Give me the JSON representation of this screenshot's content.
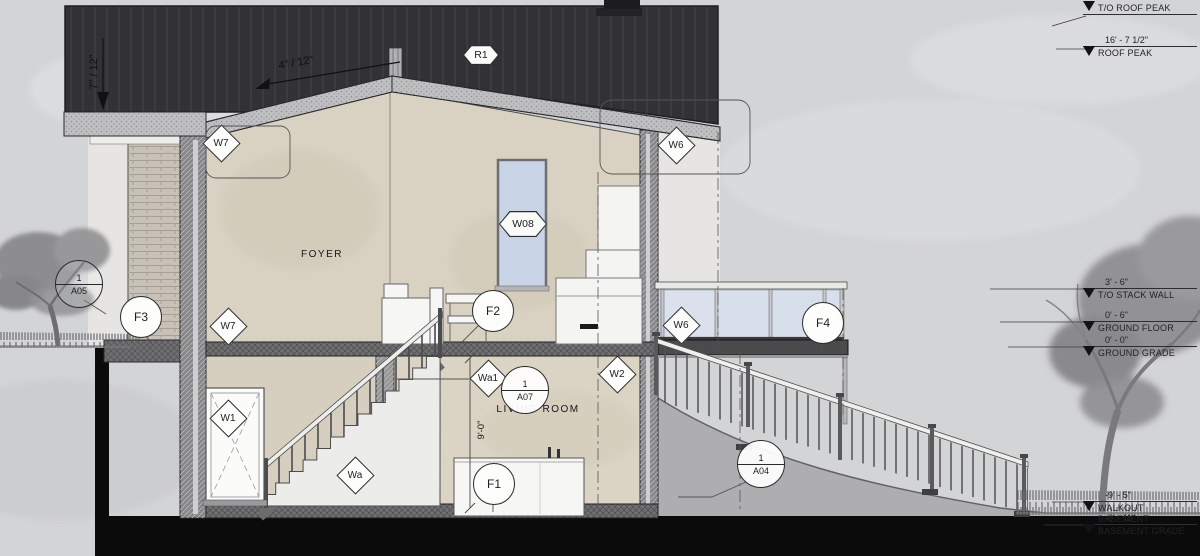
{
  "annotations": {
    "slope_left": "7\" / 12\"",
    "slope_right": "4\" / 12\"",
    "ceiling_height": "9'-0\"",
    "rooms": {
      "foyer": "FOYER",
      "living_room": "LIVING ROOM"
    }
  },
  "tags": {
    "r1": "R1",
    "w08": "W08",
    "w7_upper": "W7",
    "w6_upper": "W6",
    "w7_lower": "W7",
    "w6_lower": "W6",
    "w1": "W1",
    "w2": "W2",
    "wa": "Wa",
    "wa1": "Wa1",
    "f1": "F1",
    "f2": "F2",
    "f3": "F3",
    "f4": "F4",
    "detail_a07": {
      "number": "1",
      "sheet": "A07"
    },
    "detail_a04": {
      "number": "1",
      "sheet": "A04"
    },
    "detail_a05": {
      "number": "1",
      "sheet": "A05"
    }
  },
  "elevation_markers": [
    {
      "name": "T/O ROOF PEAK",
      "value": ""
    },
    {
      "name": "ROOF PEAK",
      "value": "16' - 7 1/2\""
    },
    {
      "name": "T/O STACK WALL",
      "value": "3' - 6\""
    },
    {
      "name": "GROUND FLOOR",
      "value": "0' - 6\""
    },
    {
      "name": "GROUND GRADE",
      "value": "0' - 0\""
    },
    {
      "name": "WALKOUT BASEMENT",
      "value": "-9' - 5\""
    },
    {
      "name": "BASEMENT GRADE",
      "value": "-9' - 11\""
    }
  ],
  "colors": {
    "sky": "#d3d4d6",
    "roof": "#323234",
    "earth": "#0b0b0b",
    "interior_wall": "#d9d2c2",
    "glass": "#d7e0ee",
    "tree": "#8e8e90",
    "cut_band": "#c0c0c2",
    "tag_fill": "#fdfdfc"
  }
}
